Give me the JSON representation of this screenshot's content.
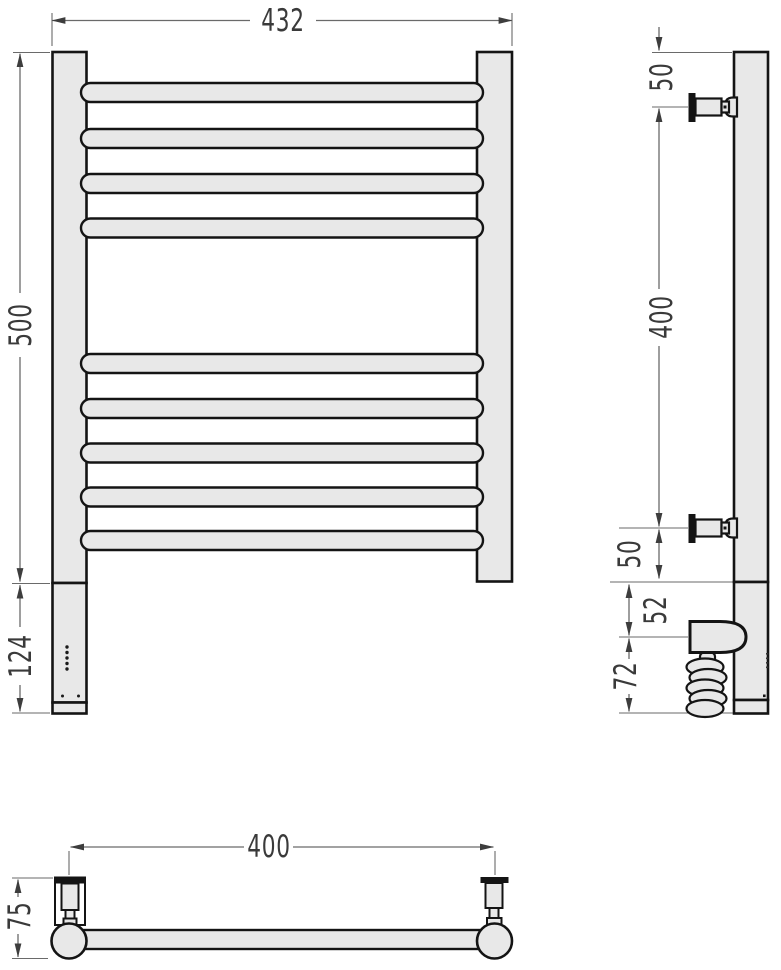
{
  "drawing": {
    "kind": "technical-drawing",
    "subject": "ladder-style heated towel rail with electric heating element, three orthographic views",
    "colors": {
      "background": "#ffffff",
      "body_fill": "#e8e8e8",
      "outline": "#141414",
      "dimension_line": "#6a6a6a",
      "dimension_text": "#3a3a3a"
    },
    "views": {
      "front": {
        "rung_count": 9,
        "dims": {
          "overall_width": "432",
          "height": "500",
          "lower_section": "124"
        }
      },
      "side": {
        "dims": {
          "top_offset": "50",
          "bracket_spacing": "400",
          "bottom_offset": "50",
          "junction_to_heater": "52",
          "heater_to_floor": "72"
        }
      },
      "top": {
        "dims": {
          "bracket_spacing": "400",
          "depth": "75"
        }
      }
    }
  }
}
